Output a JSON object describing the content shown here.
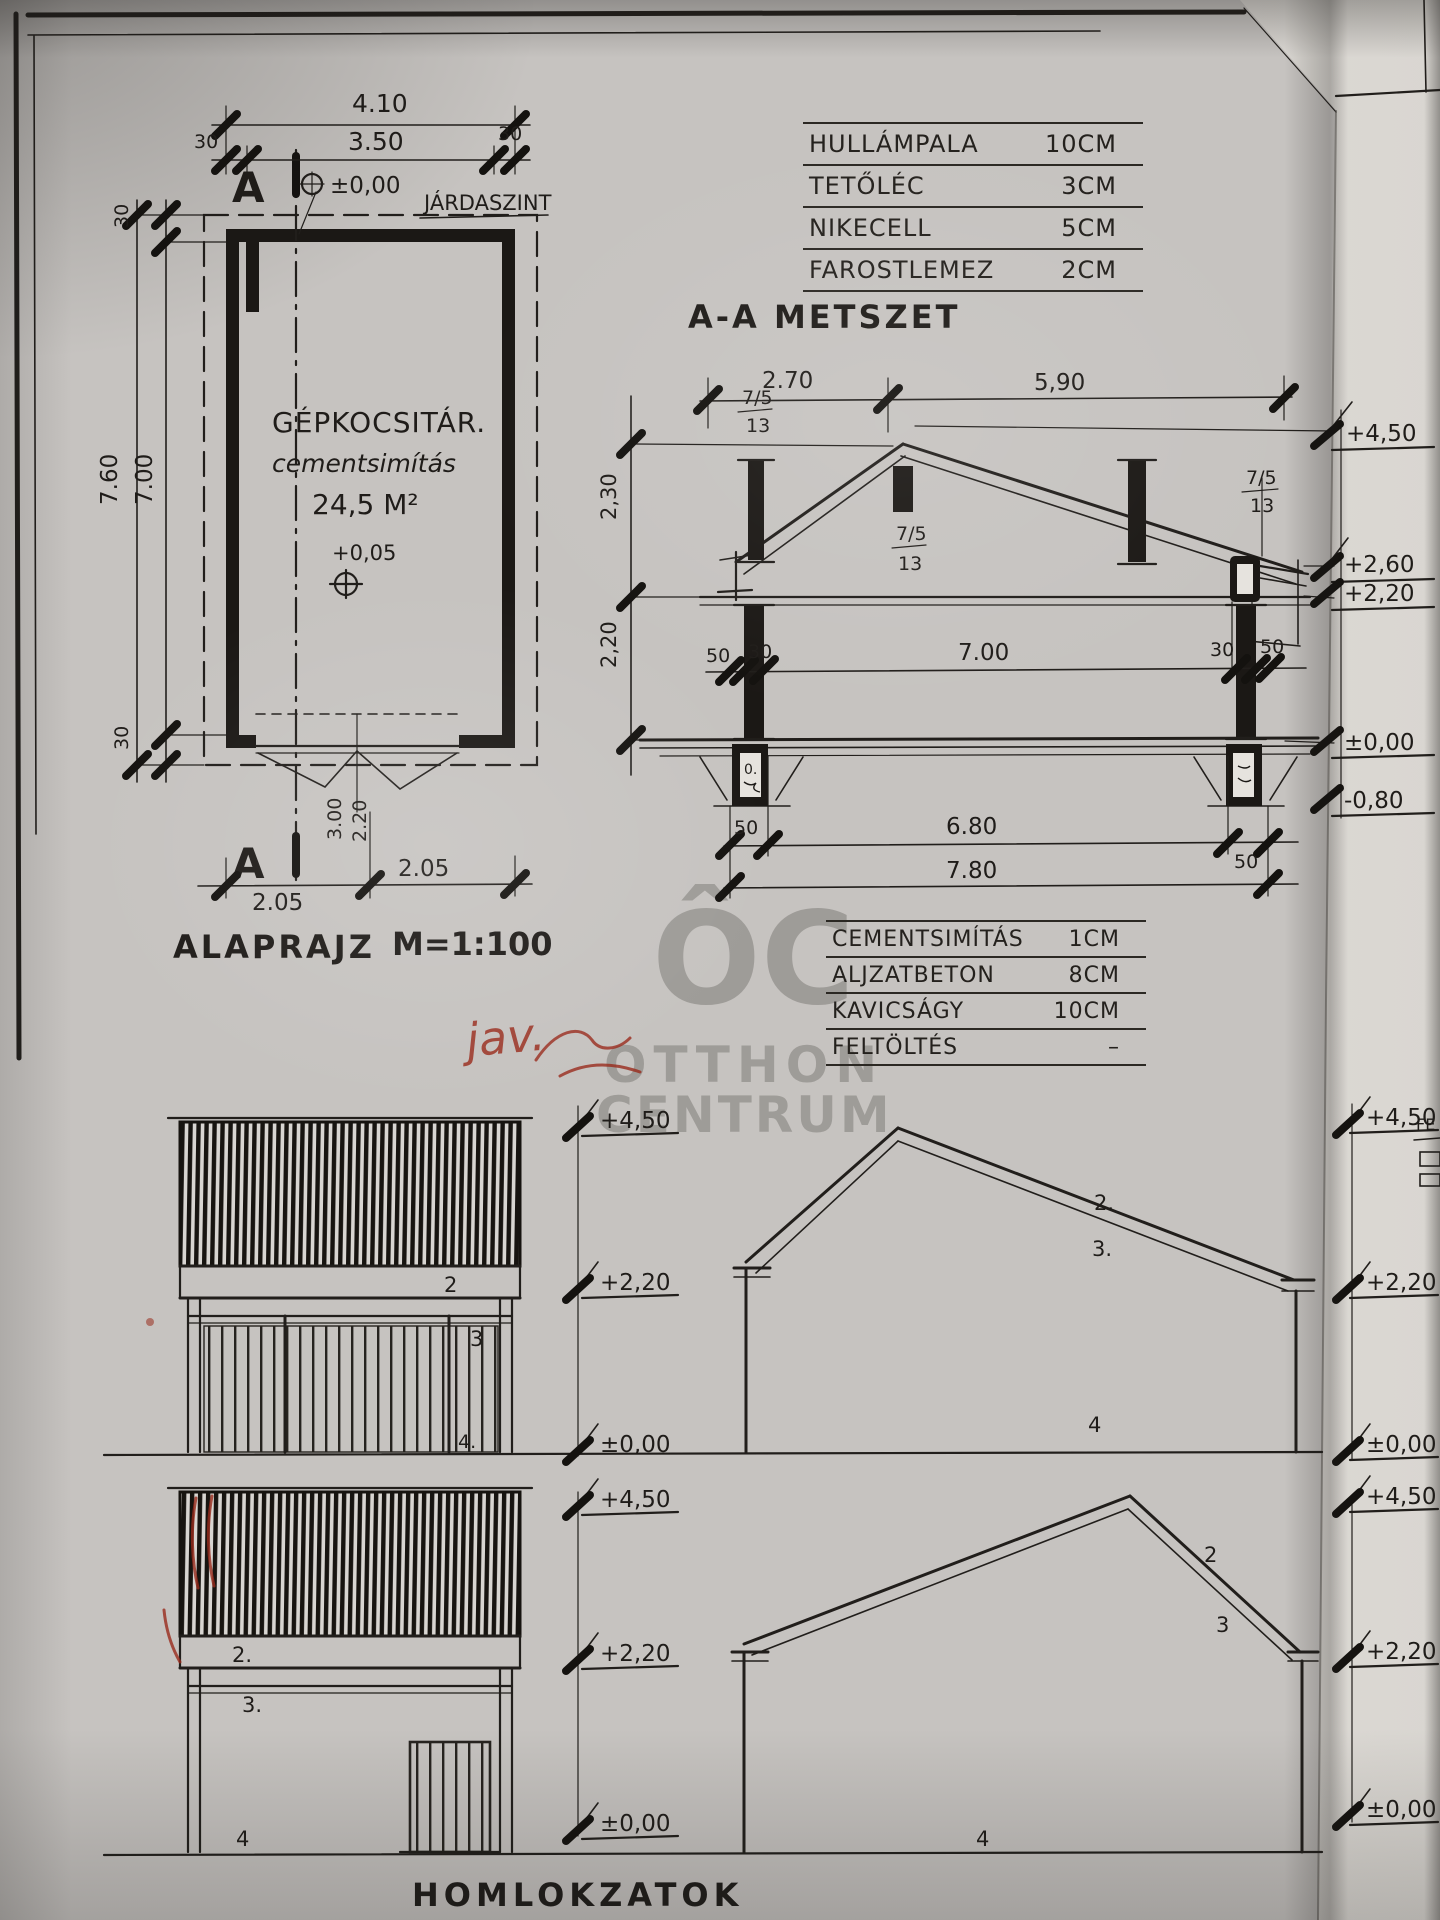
{
  "watermark": {
    "logo": "ÔC",
    "line1": "OTTHON",
    "line2": "CENTRUM"
  },
  "roof_table": {
    "rows": [
      {
        "label": "HULLÁMPALA",
        "value": "10CM"
      },
      {
        "label": "TETŐLÉC",
        "value": "3CM"
      },
      {
        "label": "NIKECELL",
        "value": "5CM"
      },
      {
        "label": "FAROSTLEMEZ",
        "value": "2CM"
      }
    ]
  },
  "floor_table": {
    "rows": [
      {
        "label": "CEMENTSIMÍTÁS",
        "value": "1CM"
      },
      {
        "label": "ALJZATBETON",
        "value": "8CM"
      },
      {
        "label": "KAVICSÁGY",
        "value": "10CM"
      },
      {
        "label": "FELTÖLTÉS",
        "value": "–"
      }
    ]
  },
  "floor_plan": {
    "title": "ALAPRAJZ",
    "scale": "M=1:100",
    "room": "GÉPKOCSITÁR.",
    "finish": "cementsimítás",
    "area": "24,5 M²",
    "level_zero": "±0,00",
    "sidewalk": "JÁRDASZINT",
    "level_floor": "+0,05",
    "marker": "A",
    "dim_total_w": "4.10",
    "dim_w": "3.50",
    "dim_30a": "30",
    "dim_30b": "30",
    "dim_total_h": "7.60",
    "dim_h": "7.00",
    "dim_30c": "30",
    "dim_30d": "30",
    "dim_b1": "2.05",
    "dim_b2": "2.05",
    "door_w": "3.00",
    "door_h": "2.20"
  },
  "section": {
    "title": "A-A METSZET",
    "dim_left": "2.70",
    "dim_right": "5,90",
    "h_roof": "2,30",
    "h_wall": "2,20",
    "d50a": "50",
    "d30a": "30",
    "span": "7.00",
    "d30b": "30",
    "d50b": "50",
    "b50a": "50",
    "b680": "6.80",
    "b50b": "50",
    "b780": "7.80",
    "rafter": "7/5",
    "batten": "13",
    "footing_note": "0.",
    "lv_450": "+4,50",
    "lv_260": "+2,60",
    "lv_220": "+2,20",
    "lv_000": "±0,00",
    "lv_m080": "-0,80"
  },
  "elevations": {
    "title": "HOMLOKZATOK",
    "n2": "2",
    "n2d": "2.",
    "n3": "3",
    "n3d": "3.",
    "n4": "4",
    "n4d": "4.",
    "lv_450": "+4,50",
    "lv_220": "+2,20",
    "lv_000": "±0,00"
  },
  "edge": {
    "partial_text": "FE"
  },
  "red_note": {
    "text": "jav."
  },
  "colors": {
    "ink": "#211e1b",
    "paper": "#c6c3c0",
    "paper_bright": "#eceae5",
    "red": "#992b1c",
    "watermark": "#5f5c58"
  }
}
